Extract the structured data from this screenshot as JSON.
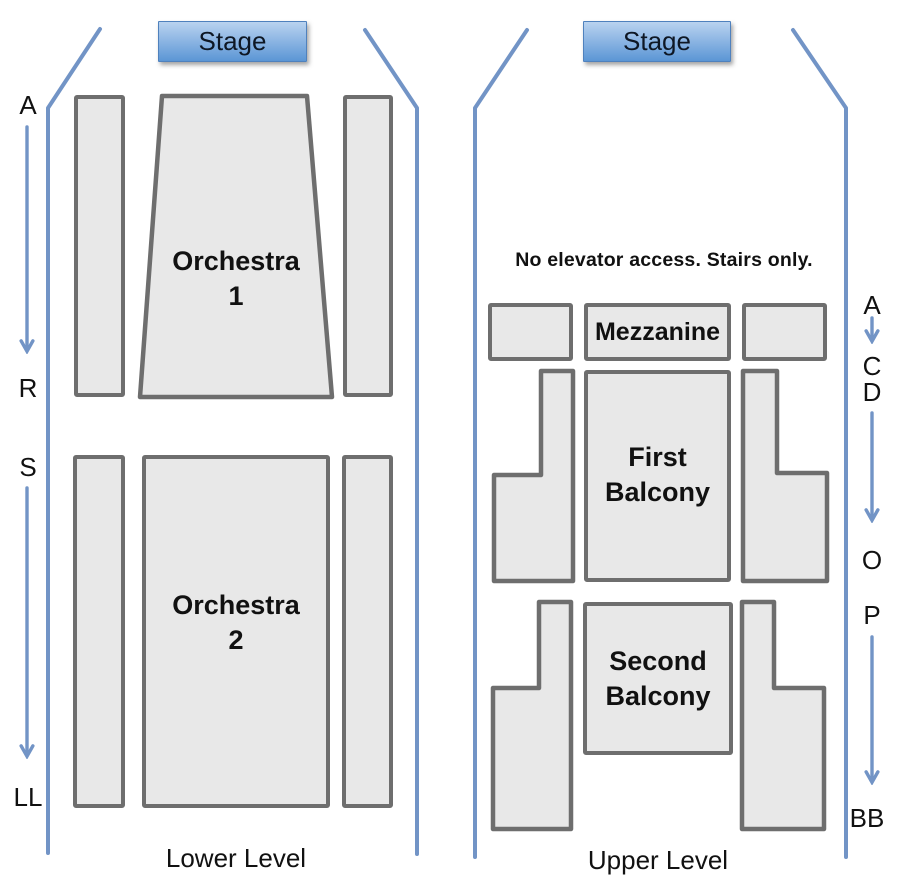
{
  "colors": {
    "accent_blue": "#7294c6",
    "stage_gradient_top": "#b9d3ef",
    "stage_gradient_bottom": "#5b96d5",
    "section_fill": "#e8e8e8",
    "section_border": "#6e6e6e",
    "text": "#111111"
  },
  "lower": {
    "stage_label": "Stage",
    "sections": {
      "orchestra1": "Orchestra\n1",
      "orchestra2": "Orchestra\n2"
    },
    "row_labels": {
      "a": "A",
      "r": "R",
      "s": "S",
      "ll": "LL"
    },
    "footer": "Lower Level"
  },
  "upper": {
    "stage_label": "Stage",
    "note": "No elevator access. Stairs only.",
    "sections": {
      "mezzanine": "Mezzanine",
      "first_balcony": "First\nBalcony",
      "second_balcony": "Second\nBalcony"
    },
    "row_labels": {
      "a": "A",
      "c": "C",
      "d": "D",
      "o": "O",
      "p": "P",
      "bb": "BB"
    },
    "footer": "Upper Level"
  }
}
